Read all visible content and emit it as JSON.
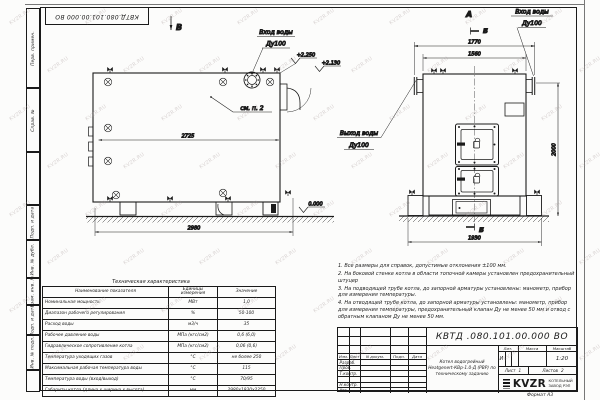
{
  "sheet": {
    "stamp_number": "КВТД.080.101.00.000 ВО",
    "format_note": "Формат А3",
    "watermark": "KVZR.RU"
  },
  "margin_columns": {
    "top": [
      "Перв. примен.",
      "Справ. №"
    ],
    "bottom": [
      "Подп. и дата",
      "Инв. № дубл.",
      "Взам. инв. №",
      "Подп. и дата",
      "Инв. № подл."
    ]
  },
  "drawing": {
    "view_side_label": "В",
    "view_front_label": "А",
    "section_label": "Б",
    "side": {
      "dim_inner": "2725",
      "dim_overall": "2980",
      "elev_top": "+2.250",
      "elev_mid": "+2.130",
      "elev_zero": "0.000",
      "see_note": "см. п. 2",
      "inlet_line1": "Вход воды",
      "inlet_line2": "Ду100"
    },
    "front": {
      "dim_flanges": "1770",
      "dim_body": "1560",
      "dim_base": "1930",
      "dim_height": "2000",
      "inlet_line1": "Вход воды",
      "inlet_line2": "Ду100",
      "outlet_line1": "Выход воды",
      "outlet_line2": "Ду100"
    }
  },
  "notes": [
    "1. Все размеры для справок, допустимые отклонения ±100 мм.",
    "2. На боковой стенке котла в области топочной камеры установлен предохранительный штуцер",
    "3. На подводящей трубе котла, до запорной арматуры установлены: манометр, прибор для измерения температуры.",
    "4. На отводящей трубе котла, до запорной арматуры установлены: манометр, прибор для измерения температуры, предохранительный клапан Ду не менее 50 мм и отвод с обратным клапаном Ду не менее 50 мм."
  ],
  "spec_table": {
    "title": "Техническая характеристика",
    "headers": [
      "Наименование показателя",
      "Единицы измерения",
      "Значение"
    ],
    "rows": [
      [
        "Номинальная мощность",
        "МВт",
        "1,0"
      ],
      [
        "Диапазон рабочего регулирования",
        "%",
        "50-100"
      ],
      [
        "Расход воды",
        "м3/ч",
        "35"
      ],
      [
        "Рабочее давление воды",
        "МПа (кгс/см2)",
        "0,6 (6,0)"
      ],
      [
        "Гидравлическое сопротивление котла",
        "МПа (кгс/см2)",
        "0,06 (0,6)"
      ],
      [
        "Температура уходящих газов",
        "°С",
        "не более 250"
      ],
      [
        "Максимальная рабочая температура воды",
        "°С",
        "115"
      ],
      [
        "Температура воды (вход/выход)",
        "°С",
        "70/95"
      ],
      [
        "Габариты котла (длина х ширина х высота)",
        "мм",
        "2980х1930х2250"
      ]
    ]
  },
  "titleblock": {
    "doc_number": "КВТД .080.101.00.000  ВО",
    "product_lines": [
      "Котел водогрейный",
      "Heatgenert-КВр-1.0-Д (РВР) по",
      "техническому заданию"
    ],
    "header_cols": [
      "Изм.",
      "Лист",
      "N докум.",
      "Подп.",
      "Дата"
    ],
    "signature_rows": [
      "Разраб.",
      "Пров.",
      "Т.контр.",
      "",
      "Н.контр.",
      "Утв."
    ],
    "lit_label": "Лит.",
    "lit_value": "И",
    "mass_label": "Масса",
    "scale_label": "Масштаб",
    "scale_value": "1:20",
    "sheet_label": "Лист",
    "sheet_value": "1",
    "sheets_label": "Листов",
    "sheets_value": "2",
    "logo_text": "KVZR",
    "company_line1": "КОТЕЛЬНЫЙ",
    "company_line2": "ЗАВОД РЭП"
  }
}
